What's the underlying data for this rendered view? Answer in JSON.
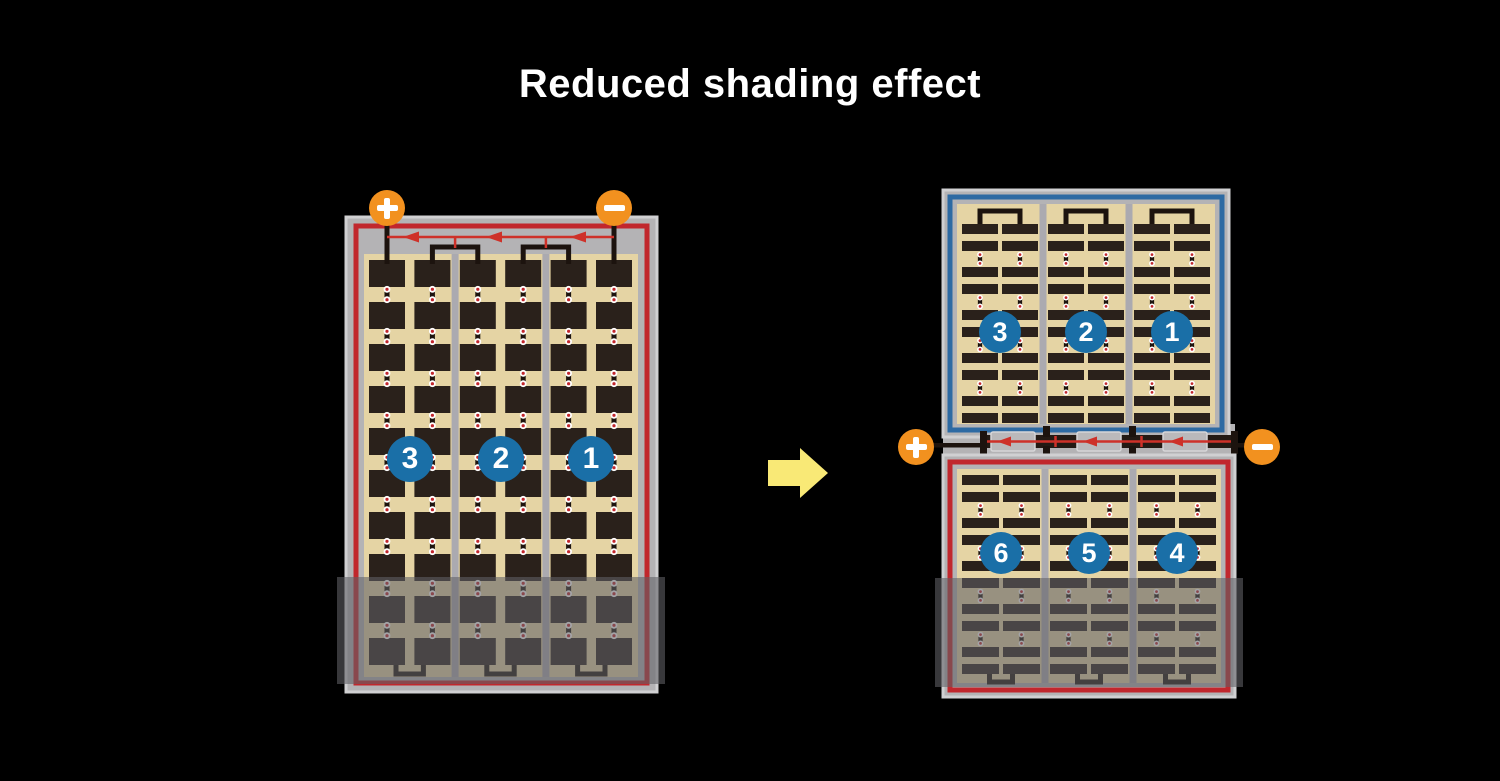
{
  "title": "Reduced shading effect",
  "colors": {
    "background": "#000000",
    "title_text": "#ffffff",
    "frame": "#b4b3b5",
    "frame_edge": "#d0d0d2",
    "tan": "#e5d4a4",
    "cell": "#2a211b",
    "wire": "#1c130e",
    "red": "#c1272d",
    "diode_red": "#ce3129",
    "blue": "#2d6aa3",
    "badge_blue": "#1a6fa7",
    "badge_text": "#ffffff",
    "orange": "#f2911f",
    "divider": "#abaab0",
    "shade": "rgba(96,96,101,0.58)",
    "arrow_yellow": "#f9e976",
    "dot_red": "#c1272d",
    "dot_white": "#ffffff",
    "junction_box": "#bab9bb",
    "junction_box_edge": "#d6d6d8",
    "bus_band": "#231a14"
  },
  "left_panel": {
    "description": "full-size panel",
    "terminals": {
      "positive": "+",
      "negative": "−"
    },
    "strings": [
      "3",
      "2",
      "1"
    ],
    "columns": 6,
    "rows": 10,
    "diodes": 3,
    "shaded_bottom_rows": 2
  },
  "right_panel": {
    "description": "half-cut panel",
    "terminals": {
      "positive": "+",
      "negative": "−"
    },
    "top_strings": [
      "3",
      "2",
      "1"
    ],
    "bottom_strings": [
      "6",
      "5",
      "4"
    ],
    "pairs_per_half": 3,
    "bar_rows_per_half": 10,
    "diodes": 3
  }
}
